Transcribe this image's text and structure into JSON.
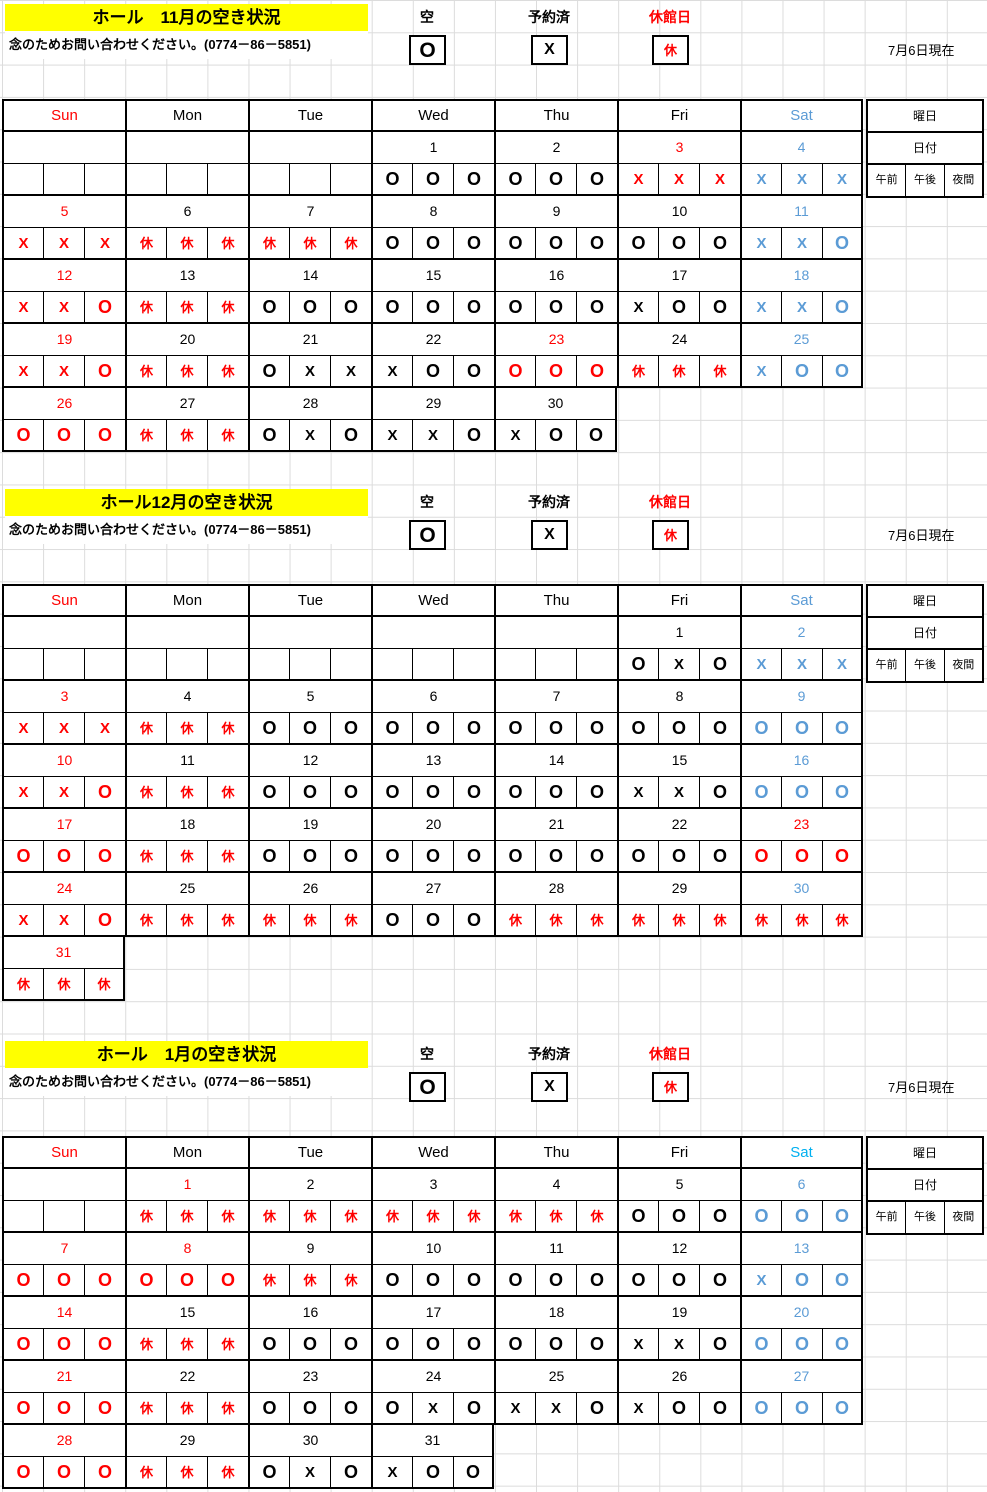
{
  "page": {
    "as_of": "7月6日現在",
    "note": "念のためお問い合わせください。(0774－86－5851)",
    "legend": {
      "available_label": "空",
      "available_mark": "O",
      "booked_label": "予約済",
      "booked_mark": "X",
      "closed_label": "休館日",
      "closed_mark": "休"
    },
    "weekday_headers": [
      "Sun",
      "Mon",
      "Tue",
      "Wed",
      "Thu",
      "Fri",
      "Sat"
    ],
    "side_box": {
      "row1": "曜日",
      "row2": "日付",
      "slots": [
        "午前",
        "午後",
        "夜間"
      ]
    }
  },
  "colors": {
    "red": "#FF0000",
    "sat_blue": "#5B9BD5",
    "jan_sat_header": "#00B0F0",
    "black": "#000000",
    "title_bg": "#FFFF00"
  },
  "months": [
    {
      "title": "ホール　11月の空き状況",
      "sat_header_color": "#5B9BD5",
      "weeks": [
        [
          {
            "d": "",
            "dc": "k",
            "s": [
              "",
              "",
              ""
            ],
            "sc": "k"
          },
          {
            "d": "",
            "dc": "k",
            "s": [
              "",
              "",
              ""
            ],
            "sc": "k"
          },
          {
            "d": "",
            "dc": "k",
            "s": [
              "",
              "",
              ""
            ],
            "sc": "k"
          },
          {
            "d": "1",
            "dc": "k",
            "s": [
              "O",
              "O",
              "O"
            ],
            "sc": "k"
          },
          {
            "d": "2",
            "dc": "k",
            "s": [
              "O",
              "O",
              "O"
            ],
            "sc": "k"
          },
          {
            "d": "3",
            "dc": "r",
            "s": [
              "X",
              "X",
              "X"
            ],
            "sc": "r"
          },
          {
            "d": "4",
            "dc": "b",
            "s": [
              "X",
              "X",
              "X"
            ],
            "sc": "b"
          }
        ],
        [
          {
            "d": "5",
            "dc": "r",
            "s": [
              "X",
              "X",
              "X"
            ],
            "sc": "r"
          },
          {
            "d": "6",
            "dc": "k",
            "s": [
              "休",
              "休",
              "休"
            ],
            "sc": "r"
          },
          {
            "d": "7",
            "dc": "k",
            "s": [
              "休",
              "休",
              "休"
            ],
            "sc": "r"
          },
          {
            "d": "8",
            "dc": "k",
            "s": [
              "O",
              "O",
              "O"
            ],
            "sc": "k"
          },
          {
            "d": "9",
            "dc": "k",
            "s": [
              "O",
              "O",
              "O"
            ],
            "sc": "k"
          },
          {
            "d": "10",
            "dc": "k",
            "s": [
              "O",
              "O",
              "O"
            ],
            "sc": "k"
          },
          {
            "d": "11",
            "dc": "b",
            "s": [
              "X",
              "X",
              "O"
            ],
            "sc": "b"
          }
        ],
        [
          {
            "d": "12",
            "dc": "r",
            "s": [
              "X",
              "X",
              "O"
            ],
            "sc": "r"
          },
          {
            "d": "13",
            "dc": "k",
            "s": [
              "休",
              "休",
              "休"
            ],
            "sc": "r"
          },
          {
            "d": "14",
            "dc": "k",
            "s": [
              "O",
              "O",
              "O"
            ],
            "sc": "k"
          },
          {
            "d": "15",
            "dc": "k",
            "s": [
              "O",
              "O",
              "O"
            ],
            "sc": "k"
          },
          {
            "d": "16",
            "dc": "k",
            "s": [
              "O",
              "O",
              "O"
            ],
            "sc": "k"
          },
          {
            "d": "17",
            "dc": "k",
            "s": [
              "X",
              "O",
              "O"
            ],
            "sc": "k"
          },
          {
            "d": "18",
            "dc": "b",
            "s": [
              "X",
              "X",
              "O"
            ],
            "sc": "b"
          }
        ],
        [
          {
            "d": "19",
            "dc": "r",
            "s": [
              "X",
              "X",
              "O"
            ],
            "sc": "r"
          },
          {
            "d": "20",
            "dc": "k",
            "s": [
              "休",
              "休",
              "休"
            ],
            "sc": "r"
          },
          {
            "d": "21",
            "dc": "k",
            "s": [
              "O",
              "X",
              "X"
            ],
            "sc": "k"
          },
          {
            "d": "22",
            "dc": "k",
            "s": [
              "X",
              "O",
              "O"
            ],
            "sc": "k"
          },
          {
            "d": "23",
            "dc": "r",
            "s": [
              "O",
              "O",
              "O"
            ],
            "sc": "r"
          },
          {
            "d": "24",
            "dc": "k",
            "s": [
              "休",
              "休",
              "休"
            ],
            "sc": "r"
          },
          {
            "d": "25",
            "dc": "b",
            "s": [
              "X",
              "O",
              "O"
            ],
            "sc": "b"
          }
        ],
        [
          {
            "d": "26",
            "dc": "r",
            "s": [
              "O",
              "O",
              "O"
            ],
            "sc": "r"
          },
          {
            "d": "27",
            "dc": "k",
            "s": [
              "休",
              "休",
              "休"
            ],
            "sc": "r"
          },
          {
            "d": "28",
            "dc": "k",
            "s": [
              "O",
              "X",
              "O"
            ],
            "sc": "k"
          },
          {
            "d": "29",
            "dc": "k",
            "s": [
              "X",
              "X",
              "O"
            ],
            "sc": "k"
          },
          {
            "d": "30",
            "dc": "k",
            "s": [
              "X",
              "O",
              "O"
            ],
            "sc": "k"
          },
          null,
          null
        ]
      ]
    },
    {
      "title": "ホール12月の空き状況",
      "sat_header_color": "#5B9BD5",
      "weeks": [
        [
          {
            "d": "",
            "dc": "k",
            "s": [
              "",
              "",
              ""
            ],
            "sc": "k"
          },
          {
            "d": "",
            "dc": "k",
            "s": [
              "",
              "",
              ""
            ],
            "sc": "k"
          },
          {
            "d": "",
            "dc": "k",
            "s": [
              "",
              "",
              ""
            ],
            "sc": "k"
          },
          {
            "d": "",
            "dc": "k",
            "s": [
              "",
              "",
              ""
            ],
            "sc": "k"
          },
          {
            "d": "",
            "dc": "k",
            "s": [
              "",
              "",
              ""
            ],
            "sc": "k"
          },
          {
            "d": "1",
            "dc": "k",
            "s": [
              "O",
              "X",
              "O"
            ],
            "sc": "k"
          },
          {
            "d": "2",
            "dc": "b",
            "s": [
              "X",
              "X",
              "X"
            ],
            "sc": "b"
          }
        ],
        [
          {
            "d": "3",
            "dc": "r",
            "s": [
              "X",
              "X",
              "X"
            ],
            "sc": "r"
          },
          {
            "d": "4",
            "dc": "k",
            "s": [
              "休",
              "休",
              "休"
            ],
            "sc": "r"
          },
          {
            "d": "5",
            "dc": "k",
            "s": [
              "O",
              "O",
              "O"
            ],
            "sc": "k"
          },
          {
            "d": "6",
            "dc": "k",
            "s": [
              "O",
              "O",
              "O"
            ],
            "sc": "k"
          },
          {
            "d": "7",
            "dc": "k",
            "s": [
              "O",
              "O",
              "O"
            ],
            "sc": "k"
          },
          {
            "d": "8",
            "dc": "k",
            "s": [
              "O",
              "O",
              "O"
            ],
            "sc": "k"
          },
          {
            "d": "9",
            "dc": "b",
            "s": [
              "O",
              "O",
              "O"
            ],
            "sc": "b"
          }
        ],
        [
          {
            "d": "10",
            "dc": "r",
            "s": [
              "X",
              "X",
              "O"
            ],
            "sc": "r"
          },
          {
            "d": "11",
            "dc": "k",
            "s": [
              "休",
              "休",
              "休"
            ],
            "sc": "r"
          },
          {
            "d": "12",
            "dc": "k",
            "s": [
              "O",
              "O",
              "O"
            ],
            "sc": "k"
          },
          {
            "d": "13",
            "dc": "k",
            "s": [
              "O",
              "O",
              "O"
            ],
            "sc": "k"
          },
          {
            "d": "14",
            "dc": "k",
            "s": [
              "O",
              "O",
              "O"
            ],
            "sc": "k"
          },
          {
            "d": "15",
            "dc": "k",
            "s": [
              "X",
              "X",
              "O"
            ],
            "sc": "k"
          },
          {
            "d": "16",
            "dc": "b",
            "s": [
              "O",
              "O",
              "O"
            ],
            "sc": "b"
          }
        ],
        [
          {
            "d": "17",
            "dc": "r",
            "s": [
              "O",
              "O",
              "O"
            ],
            "sc": "r"
          },
          {
            "d": "18",
            "dc": "k",
            "s": [
              "休",
              "休",
              "休"
            ],
            "sc": "r"
          },
          {
            "d": "19",
            "dc": "k",
            "s": [
              "O",
              "O",
              "O"
            ],
            "sc": "k"
          },
          {
            "d": "20",
            "dc": "k",
            "s": [
              "O",
              "O",
              "O"
            ],
            "sc": "k"
          },
          {
            "d": "21",
            "dc": "k",
            "s": [
              "O",
              "O",
              "O"
            ],
            "sc": "k"
          },
          {
            "d": "22",
            "dc": "k",
            "s": [
              "O",
              "O",
              "O"
            ],
            "sc": "k"
          },
          {
            "d": "23",
            "dc": "r",
            "s": [
              "O",
              "O",
              "O"
            ],
            "sc": "r"
          }
        ],
        [
          {
            "d": "24",
            "dc": "r",
            "s": [
              "X",
              "X",
              "O"
            ],
            "sc": "r"
          },
          {
            "d": "25",
            "dc": "k",
            "s": [
              "休",
              "休",
              "休"
            ],
            "sc": "r"
          },
          {
            "d": "26",
            "dc": "k",
            "s": [
              "休",
              "休",
              "休"
            ],
            "sc": "r"
          },
          {
            "d": "27",
            "dc": "k",
            "s": [
              "O",
              "O",
              "O"
            ],
            "sc": "k"
          },
          {
            "d": "28",
            "dc": "k",
            "s": [
              "休",
              "休",
              "休"
            ],
            "sc": "r"
          },
          {
            "d": "29",
            "dc": "k",
            "s": [
              "休",
              "休",
              "休"
            ],
            "sc": "r"
          },
          {
            "d": "30",
            "dc": "b",
            "s": [
              "休",
              "休",
              "休"
            ],
            "sc": "r"
          }
        ],
        [
          {
            "d": "31",
            "dc": "r",
            "s": [
              "休",
              "休",
              "休"
            ],
            "sc": "r"
          },
          null,
          null,
          null,
          null,
          null,
          null
        ]
      ]
    },
    {
      "title": "ホール　1月の空き状況",
      "sat_header_color": "#00B0F0",
      "weeks": [
        [
          {
            "d": "",
            "dc": "k",
            "s": [
              "",
              "",
              ""
            ],
            "sc": "k"
          },
          {
            "d": "1",
            "dc": "r",
            "s": [
              "休",
              "休",
              "休"
            ],
            "sc": "r"
          },
          {
            "d": "2",
            "dc": "k",
            "s": [
              "休",
              "休",
              "休"
            ],
            "sc": "r"
          },
          {
            "d": "3",
            "dc": "k",
            "s": [
              "休",
              "休",
              "休"
            ],
            "sc": "r"
          },
          {
            "d": "4",
            "dc": "k",
            "s": [
              "休",
              "休",
              "休"
            ],
            "sc": "r"
          },
          {
            "d": "5",
            "dc": "k",
            "s": [
              "O",
              "O",
              "O"
            ],
            "sc": "k"
          },
          {
            "d": "6",
            "dc": "b",
            "s": [
              "O",
              "O",
              "O"
            ],
            "sc": "b"
          }
        ],
        [
          {
            "d": "7",
            "dc": "r",
            "s": [
              "O",
              "O",
              "O"
            ],
            "sc": "r"
          },
          {
            "d": "8",
            "dc": "r",
            "s": [
              "O",
              "O",
              "O"
            ],
            "sc": "r"
          },
          {
            "d": "9",
            "dc": "k",
            "s": [
              "休",
              "休",
              "休"
            ],
            "sc": "r"
          },
          {
            "d": "10",
            "dc": "k",
            "s": [
              "O",
              "O",
              "O"
            ],
            "sc": "k"
          },
          {
            "d": "11",
            "dc": "k",
            "s": [
              "O",
              "O",
              "O"
            ],
            "sc": "k"
          },
          {
            "d": "12",
            "dc": "k",
            "s": [
              "O",
              "O",
              "O"
            ],
            "sc": "k"
          },
          {
            "d": "13",
            "dc": "b",
            "s": [
              "X",
              "O",
              "O"
            ],
            "sc": "b"
          }
        ],
        [
          {
            "d": "14",
            "dc": "r",
            "s": [
              "O",
              "O",
              "O"
            ],
            "sc": "r"
          },
          {
            "d": "15",
            "dc": "k",
            "s": [
              "休",
              "休",
              "休"
            ],
            "sc": "r"
          },
          {
            "d": "16",
            "dc": "k",
            "s": [
              "O",
              "O",
              "O"
            ],
            "sc": "k"
          },
          {
            "d": "17",
            "dc": "k",
            "s": [
              "O",
              "O",
              "O"
            ],
            "sc": "k"
          },
          {
            "d": "18",
            "dc": "k",
            "s": [
              "O",
              "O",
              "O"
            ],
            "sc": "k"
          },
          {
            "d": "19",
            "dc": "k",
            "s": [
              "X",
              "X",
              "O"
            ],
            "sc": "k"
          },
          {
            "d": "20",
            "dc": "b",
            "s": [
              "O",
              "O",
              "O"
            ],
            "sc": "b"
          }
        ],
        [
          {
            "d": "21",
            "dc": "r",
            "s": [
              "O",
              "O",
              "O"
            ],
            "sc": "r"
          },
          {
            "d": "22",
            "dc": "k",
            "s": [
              "休",
              "休",
              "休"
            ],
            "sc": "r"
          },
          {
            "d": "23",
            "dc": "k",
            "s": [
              "O",
              "O",
              "O"
            ],
            "sc": "k"
          },
          {
            "d": "24",
            "dc": "k",
            "s": [
              "O",
              "X",
              "O"
            ],
            "sc": "k"
          },
          {
            "d": "25",
            "dc": "k",
            "s": [
              "X",
              "X",
              "O"
            ],
            "sc": "k"
          },
          {
            "d": "26",
            "dc": "k",
            "s": [
              "X",
              "O",
              "O"
            ],
            "sc": "k"
          },
          {
            "d": "27",
            "dc": "b",
            "s": [
              "O",
              "O",
              "O"
            ],
            "sc": "b"
          }
        ],
        [
          {
            "d": "28",
            "dc": "r",
            "s": [
              "O",
              "O",
              "O"
            ],
            "sc": "r"
          },
          {
            "d": "29",
            "dc": "k",
            "s": [
              "休",
              "休",
              "休"
            ],
            "sc": "r"
          },
          {
            "d": "30",
            "dc": "k",
            "s": [
              "O",
              "X",
              "O"
            ],
            "sc": "k"
          },
          {
            "d": "31",
            "dc": "k",
            "s": [
              "X",
              "O",
              "O"
            ],
            "sc": "k"
          },
          null,
          null,
          null
        ]
      ]
    }
  ]
}
